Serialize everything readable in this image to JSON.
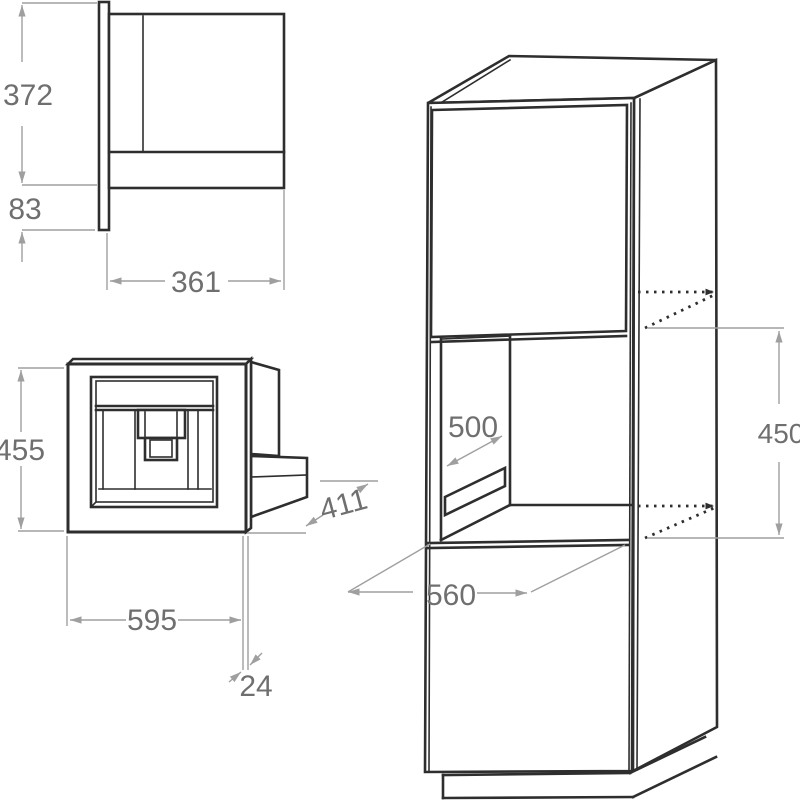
{
  "diagram": {
    "units": "mm",
    "description": "Installation drawing of a built-in coffee machine: side view, front view and tall housing unit with niche",
    "colors": {
      "object_line": "#2e2e2e",
      "dimension_line": "#9f9f9f",
      "dimension_text": "#6f6f6f",
      "background": "#ffffff"
    },
    "views": {
      "side": {
        "name": "appliance side view",
        "dims": {
          "height": "372",
          "bottom": "83",
          "depth": "361"
        }
      },
      "front": {
        "name": "appliance front view",
        "dims": {
          "height": "455",
          "width": "595",
          "panel": "24",
          "depth": "411"
        }
      },
      "cabinet": {
        "name": "tall unit with niche",
        "dims": {
          "depth": "500",
          "height": "450",
          "width": "560"
        }
      }
    }
  }
}
